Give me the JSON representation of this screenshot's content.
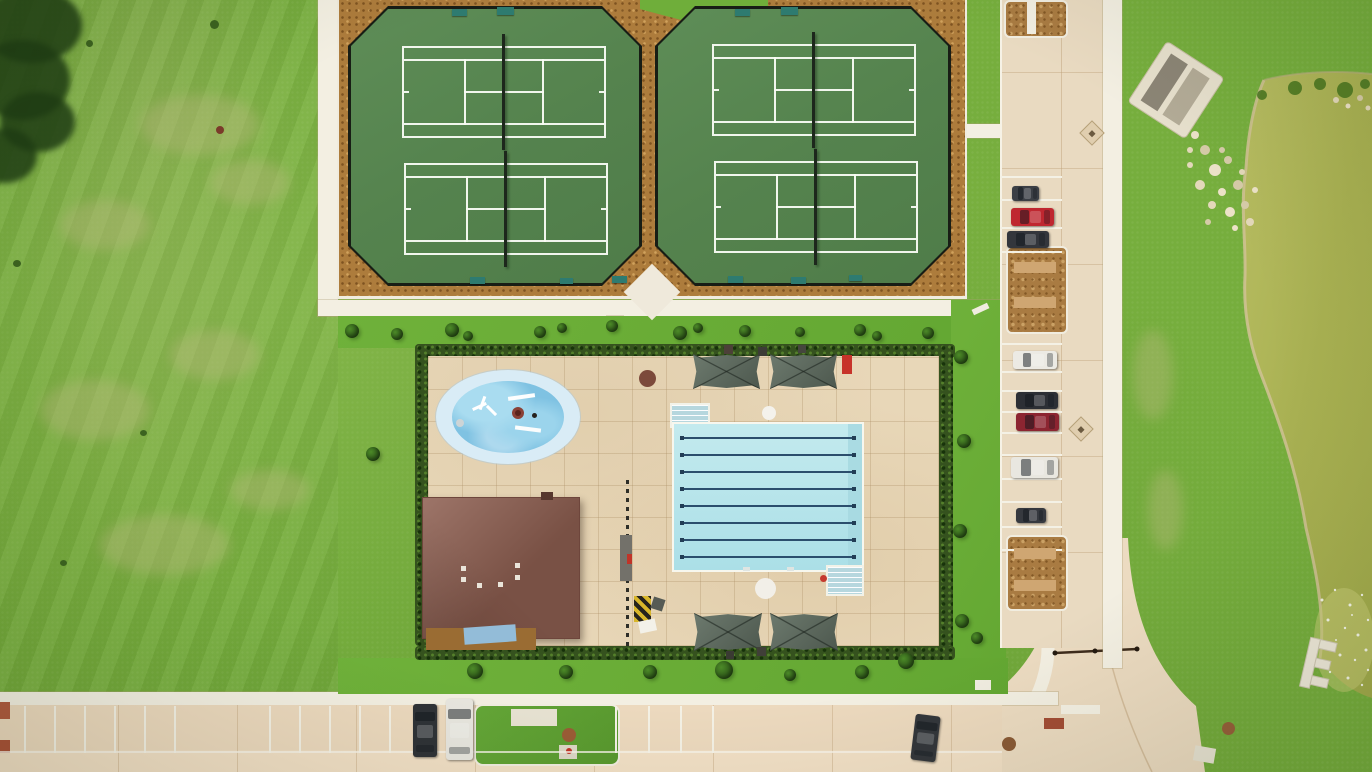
{
  "scene": {
    "description": "Aerial drone view of a community amenity center: four fenced tennis courts, an eight-lane lap pool with splash pad and pool house, shade canopies, a parking lot with cars, access roads and a pond.",
    "counts": {
      "tennis_courts": 4,
      "pool_lanes": 8,
      "shade_canopies": 4,
      "cars": 11,
      "splash_pads": 1,
      "buildings": 1,
      "ponds": 1
    }
  },
  "colors": {
    "grass": "#76ae3d",
    "court_green": "#57864f",
    "mulch": "#ad7c3c",
    "sidewalk": "#f3efe2",
    "pool_deck": "#e8d7b8",
    "pool_water": "#b9e6ec",
    "lane_line": "#2b4e6d",
    "splash_blue": "#84c5e3",
    "roof_brown": "#8d5e50",
    "canopy_gray_green": "#5e6c61",
    "hedge_green": "#35521e",
    "pond_olive": "#abb358",
    "road": "#ecdabe",
    "parking_pavement": "#e9dac1"
  },
  "tennis": {
    "court_w": 200,
    "court_h": 88,
    "courts": [
      {
        "x": 402,
        "y": 46,
        "n": "tennis-court-nw"
      },
      {
        "x": 404,
        "y": 163,
        "n": "tennis-court-sw"
      },
      {
        "x": 712,
        "y": 44,
        "n": "tennis-court-ne"
      },
      {
        "x": 714,
        "y": 161,
        "n": "tennis-court-se"
      }
    ],
    "benches": [
      {
        "x": 452,
        "y": 9,
        "w": 15,
        "h": 7,
        "c": "#2e7b70"
      },
      {
        "x": 497,
        "y": 7,
        "w": 17,
        "h": 8,
        "c": "#2e7b70"
      },
      {
        "x": 735,
        "y": 9,
        "w": 15,
        "h": 7,
        "c": "#2e7b70"
      },
      {
        "x": 781,
        "y": 7,
        "w": 17,
        "h": 8,
        "c": "#2e7b70"
      },
      {
        "x": 470,
        "y": 277,
        "w": 15,
        "h": 7,
        "c": "#2e7b70"
      },
      {
        "x": 560,
        "y": 278,
        "w": 13,
        "h": 6,
        "c": "#2e7b70"
      },
      {
        "x": 612,
        "y": 276,
        "w": 15,
        "h": 7,
        "c": "#2e7b70"
      },
      {
        "x": 728,
        "y": 276,
        "w": 15,
        "h": 7,
        "c": "#2e7b70"
      },
      {
        "x": 791,
        "y": 277,
        "w": 15,
        "h": 7,
        "c": "#2e7b70"
      },
      {
        "x": 849,
        "y": 275,
        "w": 13,
        "h": 6,
        "c": "#2e7b70"
      }
    ]
  },
  "pool": {
    "lane_ys": [
      437,
      454,
      471,
      488,
      505,
      522,
      539,
      556
    ],
    "canopies": [
      {
        "x": 693,
        "y": 354,
        "w": 67,
        "h": 35
      },
      {
        "x": 770,
        "y": 354,
        "w": 67,
        "h": 35
      },
      {
        "x": 694,
        "y": 613,
        "w": 68,
        "h": 38
      },
      {
        "x": 770,
        "y": 613,
        "w": 68,
        "h": 38
      }
    ],
    "splash_spots": [
      {
        "x": 472,
        "y": 405,
        "w": 15,
        "h": 3,
        "c": "#ffffff",
        "r": -25,
        "n": "splash-spinner-arm"
      },
      {
        "x": 481,
        "y": 396,
        "w": 3,
        "h": 14,
        "c": "#ffffff",
        "r": 20,
        "n": "splash-spinner-arm"
      },
      {
        "x": 485,
        "y": 409,
        "w": 13,
        "h": 3,
        "c": "#ffffff",
        "r": 45,
        "n": "splash-spinner-arm"
      },
      {
        "x": 512,
        "y": 407,
        "w": 12,
        "h": 12,
        "c": "#8a4136",
        "s": "circle",
        "n": "splash-feature-ring"
      },
      {
        "x": 515,
        "y": 410,
        "w": 6,
        "h": 6,
        "c": "#5a241c",
        "s": "circle",
        "n": "splash-feature-ring"
      },
      {
        "x": 532,
        "y": 413,
        "w": 5,
        "h": 5,
        "c": "#26221e",
        "s": "circle",
        "n": "splash-drain"
      },
      {
        "x": 508,
        "y": 395,
        "w": 27,
        "h": 4,
        "c": "#fdfefe",
        "r": -8,
        "n": "splash-bar"
      },
      {
        "x": 515,
        "y": 427,
        "w": 26,
        "h": 4,
        "c": "#fbfdfd",
        "r": 7,
        "n": "splash-bar"
      },
      {
        "x": 456,
        "y": 419,
        "w": 8,
        "h": 8,
        "c": "#cdd4d6",
        "s": "circle",
        "n": "splash-jet"
      }
    ]
  },
  "parking": {
    "stall_ys": [
      176,
      199,
      227,
      251,
      343,
      371,
      390,
      411,
      432,
      454,
      478,
      501,
      526,
      549
    ],
    "islands": [
      {
        "x": 1006,
        "y": 246,
        "w": 58,
        "h": 84,
        "n": "parking-island"
      },
      {
        "x": 1006,
        "y": 535,
        "w": 58,
        "h": 72,
        "n": "parking-island"
      },
      {
        "x": 1004,
        "y": 0,
        "w": 60,
        "h": 34,
        "n": "parking-island"
      },
      {
        "x": 202,
        "y": 706,
        "w": 62,
        "h": 50,
        "n": "road-island"
      }
    ]
  },
  "road": {
    "stall_xs": [
      24,
      54,
      84,
      114,
      144,
      174,
      269,
      299,
      329,
      359,
      389,
      615,
      648,
      680,
      712
    ]
  },
  "cars": [
    {
      "x": 1012,
      "y": 186,
      "w": 27,
      "h": 15,
      "c": "#3b3f45",
      "n": "car-dark-suv"
    },
    {
      "x": 1011,
      "y": 208,
      "w": 43,
      "h": 18,
      "c": "#bf2730",
      "n": "car-red"
    },
    {
      "x": 1007,
      "y": 231,
      "w": 42,
      "h": 17,
      "c": "#33363c",
      "n": "car-dark-gray"
    },
    {
      "x": 1013,
      "y": 351,
      "w": 44,
      "h": 18,
      "c": "#eceae4",
      "n": "car-white"
    },
    {
      "x": 1016,
      "y": 392,
      "w": 42,
      "h": 17,
      "c": "#2c2f35",
      "n": "car-black"
    },
    {
      "x": 1016,
      "y": 413,
      "w": 43,
      "h": 18,
      "c": "#8c2531",
      "n": "car-maroon"
    },
    {
      "x": 1011,
      "y": 457,
      "w": 47,
      "h": 21,
      "c": "#e9e7e0",
      "n": "car-white-van"
    },
    {
      "x": 1016,
      "y": 508,
      "w": 30,
      "h": 15,
      "c": "#36393f",
      "n": "car-dark-small"
    },
    {
      "x": 413,
      "y": 704,
      "w": 24,
      "h": 53,
      "c": "#2f3237",
      "v": true,
      "n": "car-dark-street"
    },
    {
      "x": 446,
      "y": 699,
      "w": 27,
      "h": 61,
      "c": "#e8e6df",
      "v": true,
      "n": "car-white-van-street"
    },
    {
      "x": 913,
      "y": 715,
      "w": 25,
      "h": 46,
      "c": "#33363b",
      "v": true,
      "r": 7,
      "n": "car-dark-street"
    }
  ],
  "vegetation": {
    "bushes": [
      {
        "x": 352,
        "y": 331,
        "r": 7
      },
      {
        "x": 397,
        "y": 334,
        "r": 6
      },
      {
        "x": 452,
        "y": 330,
        "r": 7
      },
      {
        "x": 468,
        "y": 336,
        "r": 5
      },
      {
        "x": 540,
        "y": 332,
        "r": 6
      },
      {
        "x": 562,
        "y": 328,
        "r": 5
      },
      {
        "x": 612,
        "y": 326,
        "r": 6
      },
      {
        "x": 680,
        "y": 333,
        "r": 7
      },
      {
        "x": 698,
        "y": 328,
        "r": 5
      },
      {
        "x": 745,
        "y": 331,
        "r": 6
      },
      {
        "x": 800,
        "y": 332,
        "r": 5
      },
      {
        "x": 860,
        "y": 330,
        "r": 6
      },
      {
        "x": 877,
        "y": 336,
        "r": 5
      },
      {
        "x": 928,
        "y": 333,
        "r": 6
      },
      {
        "x": 961,
        "y": 357,
        "r": 7
      },
      {
        "x": 964,
        "y": 441,
        "r": 7
      },
      {
        "x": 960,
        "y": 531,
        "r": 7
      },
      {
        "x": 962,
        "y": 621,
        "r": 7
      },
      {
        "x": 475,
        "y": 671,
        "r": 8
      },
      {
        "x": 566,
        "y": 672,
        "r": 7
      },
      {
        "x": 650,
        "y": 672,
        "r": 7
      },
      {
        "x": 724,
        "y": 670,
        "r": 9
      },
      {
        "x": 790,
        "y": 675,
        "r": 6
      },
      {
        "x": 862,
        "y": 672,
        "r": 7
      },
      {
        "x": 906,
        "y": 661,
        "r": 8
      },
      {
        "x": 977,
        "y": 638,
        "r": 6
      },
      {
        "x": 373,
        "y": 454,
        "r": 7
      }
    ],
    "tan_patches": [
      {
        "x": 140,
        "y": 95,
        "w": 120,
        "h": 60
      },
      {
        "x": 60,
        "y": 200,
        "w": 90,
        "h": 50
      },
      {
        "x": 210,
        "y": 160,
        "w": 80,
        "h": 45
      },
      {
        "x": 40,
        "y": 380,
        "w": 110,
        "h": 60
      },
      {
        "x": 170,
        "y": 330,
        "w": 90,
        "h": 50
      },
      {
        "x": 100,
        "y": 515,
        "w": 130,
        "h": 60
      },
      {
        "x": 230,
        "y": 470,
        "w": 80,
        "h": 40
      },
      {
        "x": 1133,
        "y": 330,
        "w": 40,
        "h": 90
      },
      {
        "x": 1148,
        "y": 470,
        "w": 35,
        "h": 80
      }
    ],
    "tree_shadows": [
      {
        "x": -18,
        "y": -12,
        "w": 100,
        "h": 75
      },
      {
        "x": -25,
        "y": 40,
        "w": 95,
        "h": 80
      },
      {
        "x": 0,
        "y": 92,
        "w": 75,
        "h": 60
      },
      {
        "x": -28,
        "y": 128,
        "w": 65,
        "h": 55
      }
    ],
    "specks": [
      {
        "x": 210,
        "y": 20,
        "w": 9,
        "h": 9
      },
      {
        "x": 86,
        "y": 40,
        "w": 7,
        "h": 7
      },
      {
        "x": 216,
        "y": 126,
        "w": 8,
        "h": 8,
        "c": "#7a3b2a"
      },
      {
        "x": 13,
        "y": 260,
        "w": 8,
        "h": 7
      },
      {
        "x": 140,
        "y": 430,
        "w": 7,
        "h": 6
      },
      {
        "x": 60,
        "y": 560,
        "w": 7,
        "h": 6
      }
    ]
  },
  "pond": {
    "rocks": [
      [
        1195,
        135,
        4
      ],
      [
        1205,
        150,
        5
      ],
      [
        1190,
        165,
        3
      ],
      [
        1215,
        170,
        6
      ],
      [
        1228,
        160,
        4
      ],
      [
        1200,
        185,
        5
      ],
      [
        1222,
        192,
        4
      ],
      [
        1238,
        185,
        5
      ],
      [
        1212,
        205,
        4
      ],
      [
        1230,
        212,
        5
      ],
      [
        1245,
        205,
        4
      ],
      [
        1250,
        222,
        4
      ],
      [
        1235,
        228,
        3
      ],
      [
        1222,
        150,
        3
      ],
      [
        1242,
        172,
        3
      ],
      [
        1255,
        190,
        3
      ],
      [
        1208,
        222,
        3
      ],
      [
        1190,
        150,
        3
      ],
      [
        1180,
        120,
        3
      ],
      [
        1172,
        112,
        3
      ],
      [
        1336,
        100,
        3
      ],
      [
        1348,
        106,
        2.5
      ],
      [
        1360,
        98,
        3
      ],
      [
        1368,
        108,
        2.5
      ]
    ],
    "sparkles": [
      [
        1322,
        600,
        1.5
      ],
      [
        1335,
        590,
        1.2
      ],
      [
        1350,
        605,
        1.5
      ],
      [
        1362,
        595,
        1.2
      ],
      [
        1328,
        620,
        1.5
      ],
      [
        1345,
        628,
        1.2
      ],
      [
        1358,
        635,
        1.5
      ],
      [
        1368,
        620,
        1.2
      ],
      [
        1325,
        648,
        1.2
      ],
      [
        1340,
        655,
        1.5
      ],
      [
        1355,
        660,
        1.2
      ],
      [
        1366,
        650,
        1.5
      ],
      [
        1330,
        672,
        1.2
      ],
      [
        1348,
        678,
        1.5
      ],
      [
        1362,
        685,
        1.2
      ],
      [
        1368,
        670,
        1.2
      ],
      [
        1336,
        640,
        1
      ],
      [
        1352,
        615,
        1
      ]
    ],
    "shrubs": [
      [
        1295,
        88,
        7
      ],
      [
        1320,
        84,
        6
      ],
      [
        1345,
        90,
        8
      ],
      [
        1365,
        84,
        5
      ],
      [
        1262,
        95,
        5
      ]
    ]
  },
  "spots": [
    {
      "x": 632,
      "y": 272,
      "w": 40,
      "h": 40,
      "c": "#efe9db",
      "r": 45,
      "n": "concrete-pad-diamond"
    },
    {
      "x": 426,
      "y": 628,
      "w": 110,
      "h": 22,
      "c": "#9a6c33",
      "n": "mulch-bed"
    },
    {
      "x": 464,
      "y": 626,
      "w": 52,
      "h": 17,
      "c": "#93bcd8",
      "r": -4,
      "n": "blue-tarp"
    },
    {
      "x": 541,
      "y": 492,
      "w": 12,
      "h": 8,
      "c": "#57372e",
      "n": "roof-chimney"
    },
    {
      "x": 461,
      "y": 566,
      "w": 5,
      "h": 5,
      "c": "#eae5da",
      "n": "roof-vent"
    },
    {
      "x": 461,
      "y": 577,
      "w": 5,
      "h": 5,
      "c": "#eae5da",
      "n": "roof-vent"
    },
    {
      "x": 477,
      "y": 583,
      "w": 5,
      "h": 5,
      "c": "#eae5da",
      "n": "roof-vent"
    },
    {
      "x": 498,
      "y": 582,
      "w": 5,
      "h": 5,
      "c": "#eae5da",
      "n": "roof-vent"
    },
    {
      "x": 515,
      "y": 563,
      "w": 5,
      "h": 5,
      "c": "#eae5da",
      "n": "roof-vent"
    },
    {
      "x": 515,
      "y": 575,
      "w": 5,
      "h": 5,
      "c": "#eae5da",
      "n": "roof-vent"
    },
    {
      "x": 620,
      "y": 535,
      "w": 12,
      "h": 46,
      "c": "#73716a",
      "n": "gate-post"
    },
    {
      "x": 627,
      "y": 554,
      "w": 5,
      "h": 10,
      "c": "#c03428",
      "n": "red-valve"
    },
    {
      "x": 634,
      "y": 596,
      "w": 17,
      "h": 26,
      "s": "stripes",
      "n": "caution-mat"
    },
    {
      "x": 652,
      "y": 598,
      "w": 12,
      "h": 12,
      "c": "#565b55",
      "r": 18,
      "n": "gray-mat"
    },
    {
      "x": 639,
      "y": 620,
      "w": 17,
      "h": 12,
      "c": "#f3f1e9",
      "r": -12,
      "n": "white-mat"
    },
    {
      "x": 842,
      "y": 355,
      "w": 10,
      "h": 19,
      "c": "#c7332a",
      "n": "red-lounge-chair"
    },
    {
      "x": 639,
      "y": 370,
      "w": 17,
      "h": 17,
      "c": "#7c4a3b",
      "s": "circle",
      "n": "patio-table"
    },
    {
      "x": 762,
      "y": 406,
      "w": 14,
      "h": 14,
      "c": "#f4f2ec",
      "s": "circle",
      "n": "white-table"
    },
    {
      "x": 755,
      "y": 578,
      "w": 21,
      "h": 21,
      "c": "#f2efe8",
      "s": "circle",
      "n": "white-table"
    },
    {
      "x": 724,
      "y": 345,
      "w": 9,
      "h": 9,
      "c": "#4c4038",
      "n": "trash-bin"
    },
    {
      "x": 758,
      "y": 347,
      "w": 9,
      "h": 9,
      "c": "#3c3c36",
      "n": "trash-bin"
    },
    {
      "x": 798,
      "y": 345,
      "w": 8,
      "h": 8,
      "c": "#45453d",
      "n": "trash-bin"
    },
    {
      "x": 726,
      "y": 651,
      "w": 8,
      "h": 8,
      "c": "#3a3a33",
      "n": "trash-bin"
    },
    {
      "x": 757,
      "y": 647,
      "w": 9,
      "h": 9,
      "c": "#403f38",
      "n": "trash-bin"
    },
    {
      "x": 820,
      "y": 575,
      "w": 7,
      "h": 7,
      "c": "#c5392e",
      "s": "circle",
      "n": "red-float"
    },
    {
      "x": 743,
      "y": 567,
      "w": 7,
      "h": 4,
      "c": "#dfe5e2",
      "n": "pool-ladder"
    },
    {
      "x": 787,
      "y": 567,
      "w": 7,
      "h": 4,
      "c": "#dfe5e2",
      "n": "pool-ladder"
    },
    {
      "x": 972,
      "y": 306,
      "w": 17,
      "h": 6,
      "c": "#f0ece0",
      "r": -25,
      "n": "bench-white"
    },
    {
      "x": 1014,
      "y": 262,
      "w": 42,
      "h": 11,
      "c": "#cfa672",
      "n": "island-path"
    },
    {
      "x": 1014,
      "y": 297,
      "w": 42,
      "h": 11,
      "c": "#cfa672",
      "n": "island-path"
    },
    {
      "x": 1014,
      "y": 548,
      "w": 42,
      "h": 11,
      "c": "#cfa672",
      "n": "island-path"
    },
    {
      "x": 1014,
      "y": 580,
      "w": 42,
      "h": 11,
      "c": "#cfa672",
      "n": "island-path"
    },
    {
      "x": 1027,
      "y": 0,
      "w": 9,
      "h": 34,
      "c": "#f2eee2",
      "n": "island-curb"
    },
    {
      "x": 1083,
      "y": 124,
      "w": 16,
      "h": 16,
      "s": "drain",
      "n": "storm-drain"
    },
    {
      "x": 1072,
      "y": 420,
      "w": 16,
      "h": 16,
      "s": "drain",
      "n": "storm-drain"
    },
    {
      "x": 1002,
      "y": 737,
      "w": 14,
      "h": 14,
      "c": "#8a5a36",
      "s": "circle",
      "n": "manhole"
    },
    {
      "x": 1222,
      "y": 722,
      "w": 13,
      "h": 13,
      "c": "#96603a",
      "s": "circle",
      "n": "manhole"
    },
    {
      "x": 562,
      "y": 728,
      "w": 14,
      "h": 14,
      "c": "#9a5c36",
      "s": "circle",
      "n": "manhole"
    },
    {
      "x": 511,
      "y": 709,
      "w": 46,
      "h": 17,
      "c": "#e7e2d2",
      "n": "sign-pad"
    },
    {
      "x": 559,
      "y": 745,
      "w": 18,
      "h": 14,
      "c": "#dcd7c6",
      "n": "utility-pad"
    },
    {
      "x": 566,
      "y": 748,
      "w": 6,
      "h": 6,
      "c": "#c23227",
      "s": "circle",
      "n": "red-marker"
    },
    {
      "x": 1194,
      "y": 747,
      "w": 21,
      "h": 15,
      "c": "#e9e4d4",
      "r": 10,
      "n": "concrete-pad"
    },
    {
      "x": 975,
      "y": 680,
      "w": 16,
      "h": 10,
      "c": "#f0ece0",
      "n": "concrete-pad"
    },
    {
      "x": 1044,
      "y": 718,
      "w": 20,
      "h": 11,
      "c": "#a34d35",
      "n": "brick-paver"
    },
    {
      "x": 0,
      "y": 702,
      "w": 10,
      "h": 17,
      "c": "#b05a3f",
      "n": "curb-marking"
    },
    {
      "x": 0,
      "y": 740,
      "w": 10,
      "h": 13,
      "c": "#ab5238",
      "n": "curb-marking"
    },
    {
      "x": 0,
      "y": 751,
      "w": 1002,
      "h": 2,
      "c": "#f8f4ea",
      "o": 0.75,
      "n": "road-joint"
    },
    {
      "x": 1061,
      "y": 705,
      "w": 39,
      "h": 9,
      "c": "#f5f1e4",
      "n": "crosswalk"
    }
  ]
}
